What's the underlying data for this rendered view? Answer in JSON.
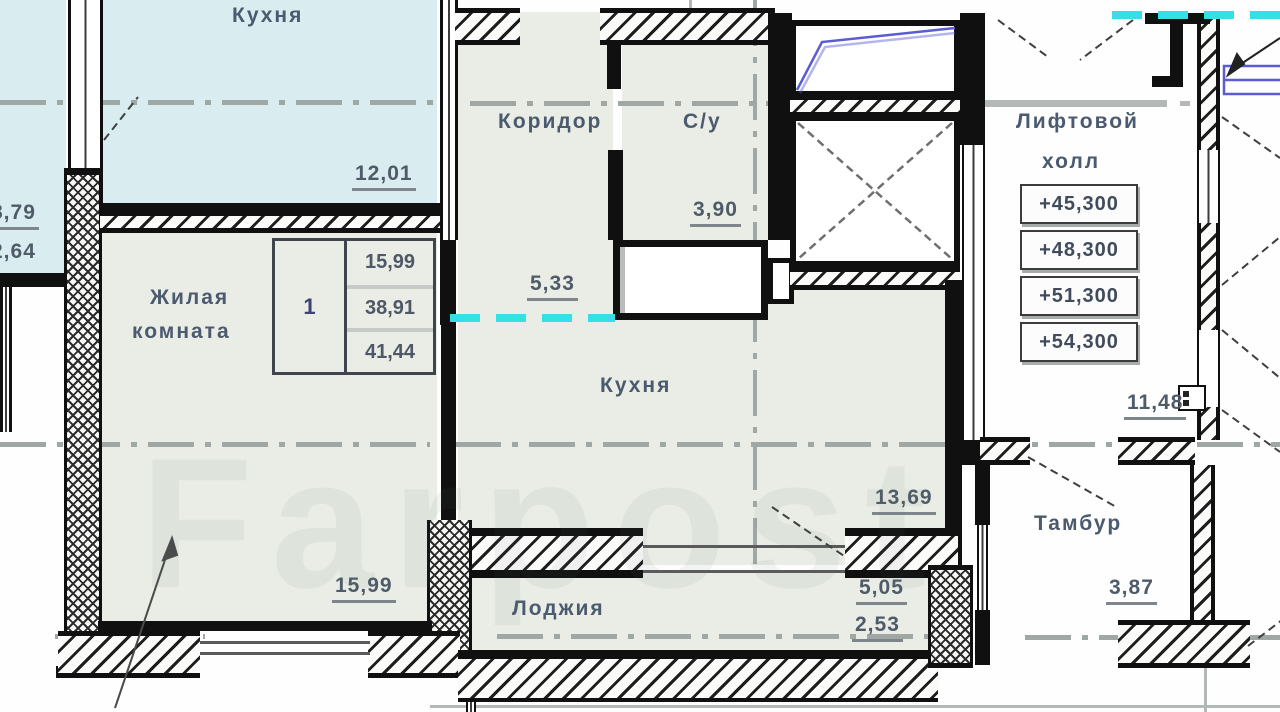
{
  "watermark": "Farpost",
  "rooms": {
    "kitchen_top": {
      "name": "Кухня",
      "area": "12,01"
    },
    "side_room": {
      "dim_a": "8,79",
      "dim_b": "2,64"
    },
    "living_room": {
      "name_line1": "Жилая",
      "name_line2": "комната",
      "area": "15,99"
    },
    "corridor": {
      "name": "Коридор",
      "area": "5,33"
    },
    "bathroom": {
      "name": "С/у",
      "area": "3,90"
    },
    "kitchen_main": {
      "name": "Кухня",
      "area": "13,69"
    },
    "lift_hall": {
      "name_line1": "Лифтовой",
      "name_line2": "холл",
      "area": "11,48"
    },
    "tambour": {
      "name": "Тамбур",
      "area": "3,87"
    },
    "loggia": {
      "name": "Лоджия",
      "area_total": "5,05",
      "area_reduced": "2,53"
    }
  },
  "info_table": {
    "flat_number": "1",
    "living_area": "15,99",
    "area_wo_loggia": "38,91",
    "total_area": "41,44"
  },
  "elevations": [
    "+45,300",
    "+48,300",
    "+51,300",
    "+54,300"
  ],
  "colors": {
    "room_green": "#e9ede6",
    "room_cyan": "#d9ecef",
    "wall": "#101010",
    "axis": "#a0a8a6",
    "cyan_dash": "#35dfe8",
    "stair_blue": "#5b5bd6",
    "text": "#4b5a6e"
  }
}
